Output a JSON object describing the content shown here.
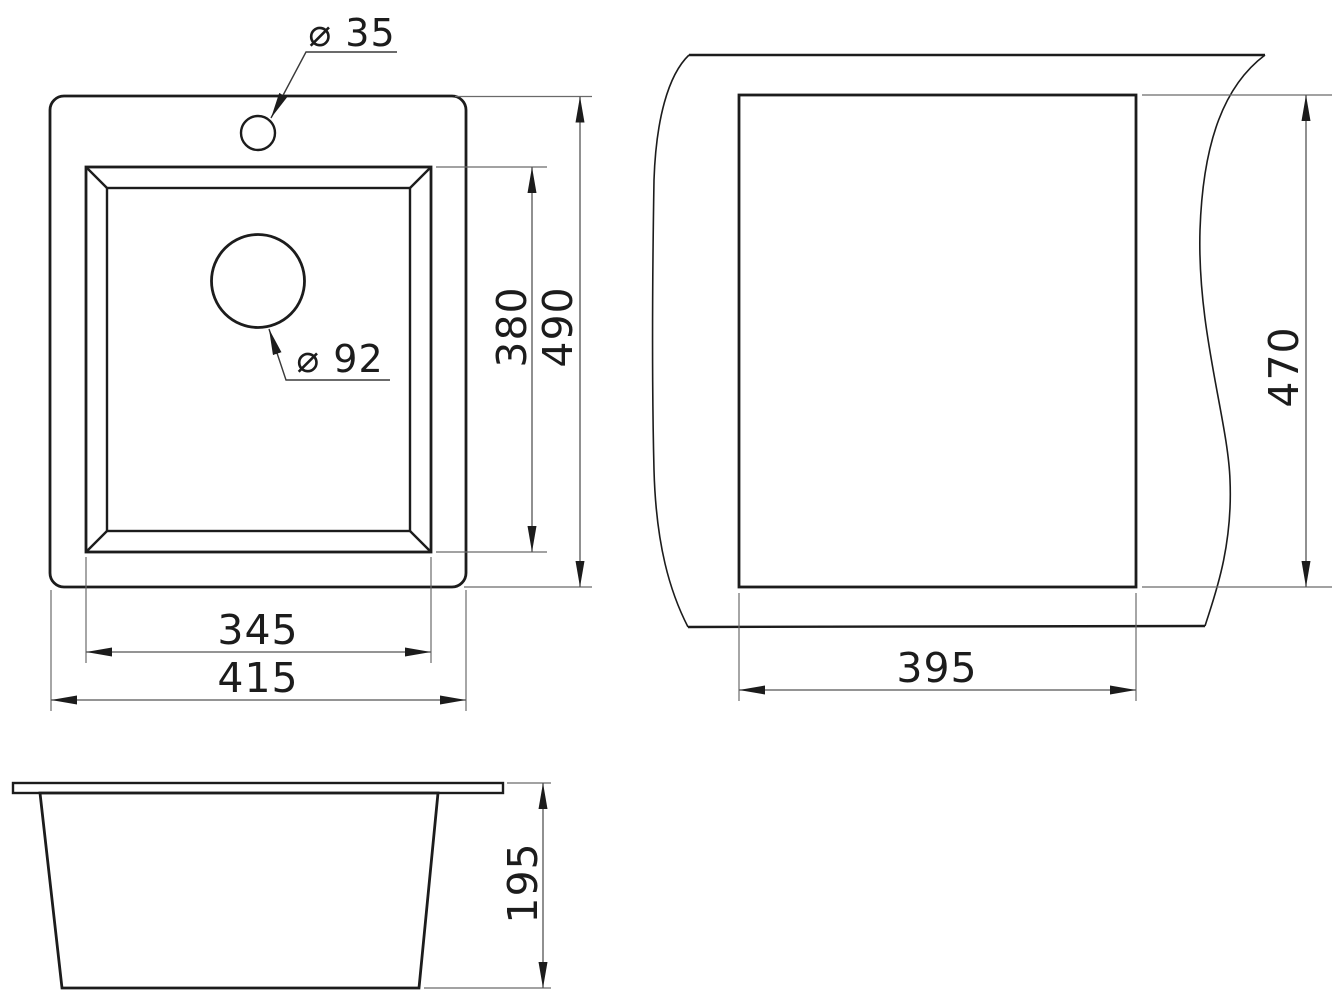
{
  "drawing": {
    "units": "mm",
    "colors": {
      "background": "#ffffff",
      "outline": "#1c1c1c",
      "dimension_lines": "#555555",
      "text": "#1c1c1c"
    },
    "views": {
      "top": {
        "labels": {
          "faucet_hole_diameter": "⌀ 35",
          "drain_hole_diameter": "⌀ 92",
          "bowl_width": "345",
          "overall_width": "415",
          "bowl_length": "380",
          "overall_length": "490"
        }
      },
      "cutout": {
        "labels": {
          "cutout_width": "395",
          "cutout_length": "470"
        }
      },
      "side": {
        "labels": {
          "overall_height": "195"
        }
      }
    }
  }
}
